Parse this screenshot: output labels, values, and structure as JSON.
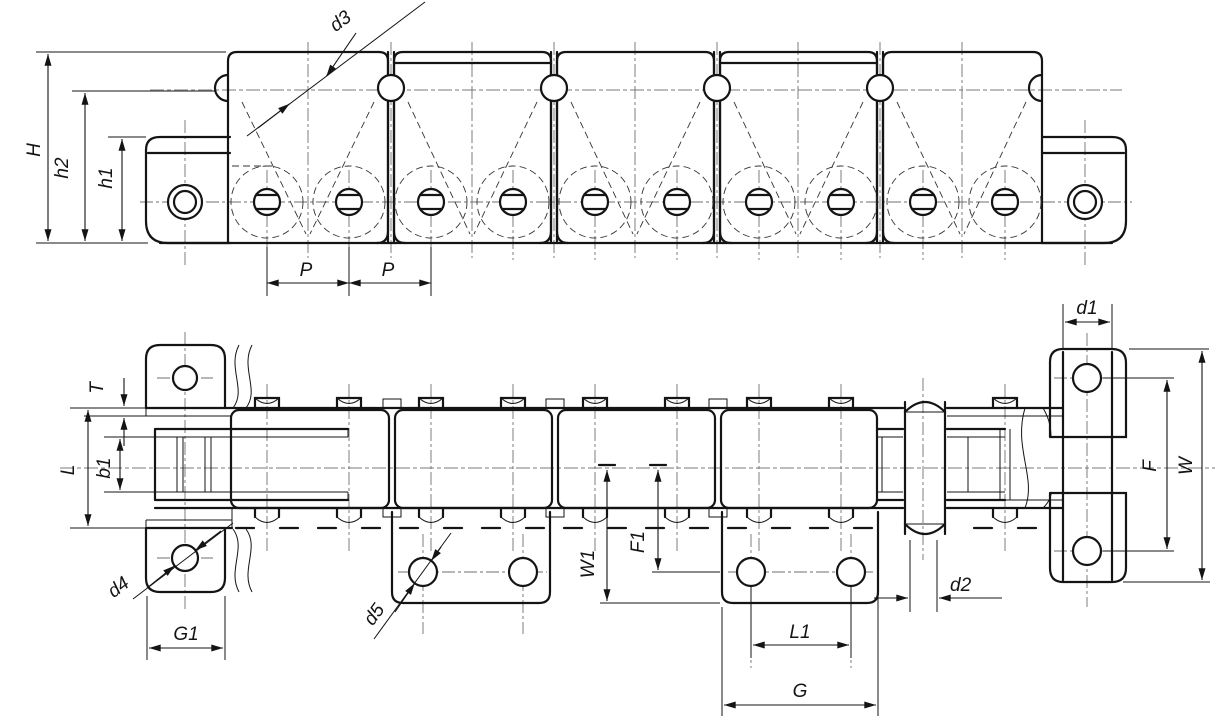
{
  "drawing": {
    "kind": "roller chain with bent attachment plates, two-view dimensioned drawing",
    "background": "#ffffff",
    "line_color": "#141414",
    "centerline_color": "#8a8a8a"
  },
  "dims": {
    "top": {
      "H": "H",
      "h2": "h2",
      "h1": "h1",
      "d3": "d3",
      "P_left": "P",
      "P_right": "P"
    },
    "plan": {
      "T": "T",
      "L": "L",
      "b1": "b1",
      "d4": "d4",
      "G1": "G1",
      "d5": "d5",
      "W1": "W1",
      "F1": "F1",
      "L1": "L1",
      "G": "G",
      "d2": "d2",
      "d1": "d1",
      "F": "F",
      "W": "W"
    }
  }
}
